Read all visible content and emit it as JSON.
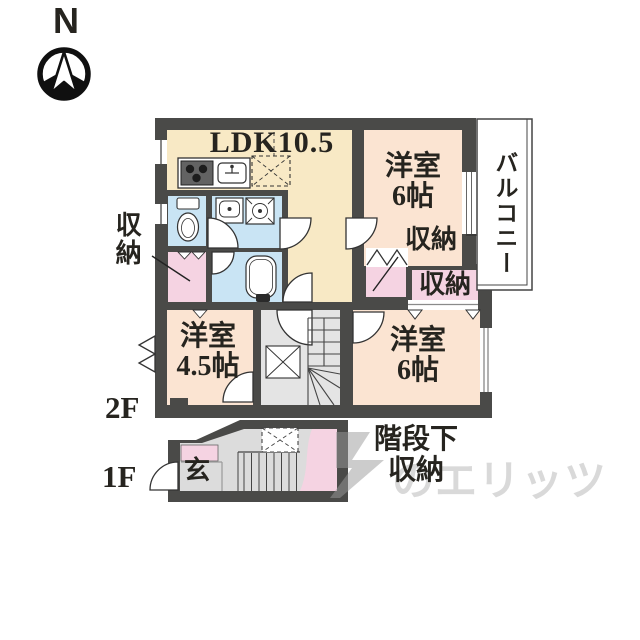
{
  "compass": {
    "north": "N"
  },
  "floor2": {
    "tag": "2F",
    "ldk": "LDK10.5",
    "bedroom_ne": "洋室\n6帖",
    "bedroom_se": "洋室\n6帖",
    "bedroom_sw": "洋室\n4.5帖",
    "closet_left": "収納",
    "closet_ne": "収納",
    "closet_se": "収納",
    "balcony": "バルコニー"
  },
  "floor1": {
    "tag": "1F",
    "genkan": "玄",
    "under_stairs": "階段下\n収納"
  },
  "watermark": {
    "text": "のエリッツ"
  },
  "colors": {
    "wall": "#4a4a48",
    "ldk": "#f8e9c5",
    "bedroom": "#fbe4d2",
    "sanitary": "#c9e4f4",
    "closet": "#f5d3e2",
    "hall": "#e4e4e4",
    "floor1": "#dcdcdc",
    "watermark": "#d9d9d9",
    "text": "#26241f"
  }
}
